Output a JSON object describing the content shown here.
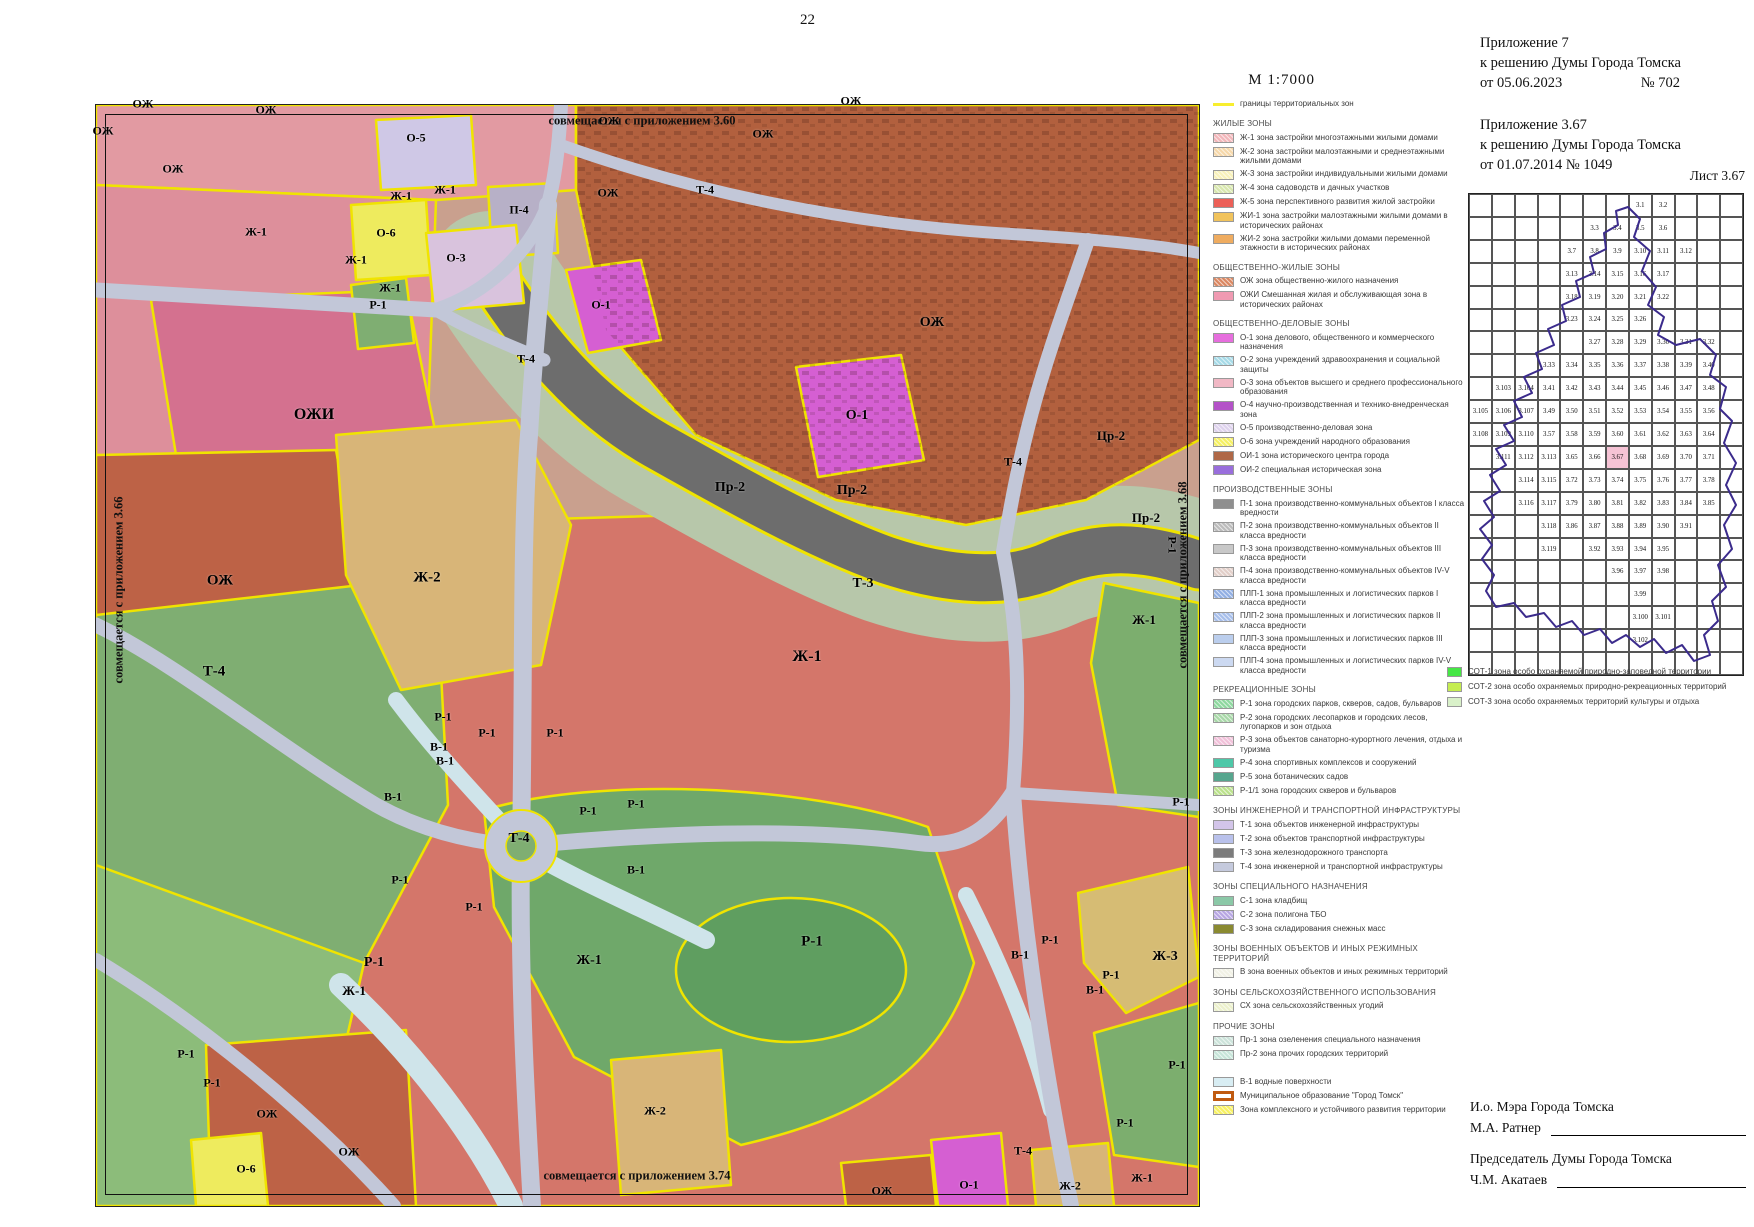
{
  "page": {
    "number": "22",
    "scale": "М 1:7000"
  },
  "header": {
    "a7_1": "Приложение 7",
    "a7_2": "к решению Думы Города Томска",
    "a7_3a": "от 05.06.2023",
    "a7_3b": "№ 702",
    "a367_1": "Приложение 3.67",
    "a367_2": "к решению Думы Города Томска",
    "a367_3": "от 01.07.2014  № 1049",
    "sheet": "Лист 3.67"
  },
  "map": {
    "edge_notes": {
      "top": "совмещается с приложением 3.60",
      "left": "совмещается с приложением 3.66",
      "right": "совмещается с приложением 3.68",
      "bottom": "совмещается с приложением 3.74"
    },
    "labels": [
      {
        "t": "ОЖ",
        "x": 143,
        "y": 104
      },
      {
        "t": "ОЖ",
        "x": 266,
        "y": 110
      },
      {
        "t": "ОЖ",
        "x": 103,
        "y": 131
      },
      {
        "t": "ОЖ",
        "x": 173,
        "y": 169
      },
      {
        "t": "О-5",
        "x": 416,
        "y": 138
      },
      {
        "t": "ОЖ",
        "x": 609,
        "y": 121
      },
      {
        "t": "ОЖ",
        "x": 763,
        "y": 134
      },
      {
        "t": "ОЖ",
        "x": 851,
        "y": 101
      },
      {
        "t": "Ж-1",
        "x": 401,
        "y": 196
      },
      {
        "t": "Ж-1",
        "x": 445,
        "y": 190
      },
      {
        "t": "П-4",
        "x": 519,
        "y": 210
      },
      {
        "t": "ОЖ",
        "x": 608,
        "y": 193
      },
      {
        "t": "Т-4",
        "x": 705,
        "y": 190
      },
      {
        "t": "Ж-1",
        "x": 256,
        "y": 232
      },
      {
        "t": "О-6",
        "x": 386,
        "y": 233
      },
      {
        "t": "О-3",
        "x": 456,
        "y": 258
      },
      {
        "t": "Ж-1",
        "x": 356,
        "y": 260
      },
      {
        "t": "Ж-1",
        "x": 390,
        "y": 288
      },
      {
        "t": "Р-1",
        "x": 378,
        "y": 305
      },
      {
        "t": "О-1",
        "x": 601,
        "y": 305
      },
      {
        "t": "Т-4",
        "x": 526,
        "y": 359
      },
      {
        "t": "ОЖ",
        "x": 932,
        "y": 323,
        "s": 14
      },
      {
        "t": "О-1",
        "x": 857,
        "y": 416,
        "s": 14
      },
      {
        "t": "Т-4",
        "x": 1013,
        "y": 462
      },
      {
        "t": "Цр-2",
        "x": 1111,
        "y": 436,
        "s": 13
      },
      {
        "t": "ОЖИ",
        "x": 314,
        "y": 415,
        "s": 16
      },
      {
        "t": "Пр-2",
        "x": 730,
        "y": 488,
        "s": 14
      },
      {
        "t": "Пр-2",
        "x": 852,
        "y": 491,
        "s": 14
      },
      {
        "t": "Пр-2",
        "x": 1146,
        "y": 518,
        "s": 13
      },
      {
        "t": "ОЖ",
        "x": 220,
        "y": 581,
        "s": 15
      },
      {
        "t": "Ж-2",
        "x": 427,
        "y": 578,
        "s": 15
      },
      {
        "t": "Т-3",
        "x": 863,
        "y": 584,
        "s": 14
      },
      {
        "t": "Ж-1",
        "x": 1144,
        "y": 620,
        "s": 13
      },
      {
        "t": "Р-1",
        "x": 1172,
        "y": 545,
        "r": 90
      },
      {
        "t": "Т-4",
        "x": 214,
        "y": 672,
        "s": 15
      },
      {
        "t": "Ж-1",
        "x": 807,
        "y": 657,
        "s": 16
      },
      {
        "t": "Р-1",
        "x": 443,
        "y": 717
      },
      {
        "t": "Р-1",
        "x": 487,
        "y": 733
      },
      {
        "t": "В-1",
        "x": 439,
        "y": 747
      },
      {
        "t": "Р-1",
        "x": 555,
        "y": 733
      },
      {
        "t": "В-1",
        "x": 445,
        "y": 761
      },
      {
        "t": "В-1",
        "x": 393,
        "y": 797
      },
      {
        "t": "Р-1",
        "x": 588,
        "y": 811
      },
      {
        "t": "Р-1",
        "x": 636,
        "y": 804
      },
      {
        "t": "Т-4",
        "x": 519,
        "y": 839,
        "s": 14
      },
      {
        "t": "В-1",
        "x": 636,
        "y": 870
      },
      {
        "t": "Р-1",
        "x": 400,
        "y": 880
      },
      {
        "t": "Р-1",
        "x": 474,
        "y": 907
      },
      {
        "t": "Р-1",
        "x": 1181,
        "y": 802
      },
      {
        "t": "Р-1",
        "x": 812,
        "y": 942,
        "s": 15
      },
      {
        "t": "Р-1",
        "x": 1050,
        "y": 940
      },
      {
        "t": "В-1",
        "x": 1020,
        "y": 955
      },
      {
        "t": "Ж-1",
        "x": 589,
        "y": 961,
        "s": 14
      },
      {
        "t": "Р-1",
        "x": 374,
        "y": 963,
        "s": 14
      },
      {
        "t": "Ж-3",
        "x": 1165,
        "y": 957,
        "s": 14
      },
      {
        "t": "Р-1",
        "x": 1111,
        "y": 975
      },
      {
        "t": "В-1",
        "x": 1095,
        "y": 990
      },
      {
        "t": "Ж-1",
        "x": 354,
        "y": 991,
        "s": 13
      },
      {
        "t": "Р-1",
        "x": 186,
        "y": 1054
      },
      {
        "t": "Р-1",
        "x": 212,
        "y": 1083
      },
      {
        "t": "ОЖ",
        "x": 267,
        "y": 1114
      },
      {
        "t": "Ж-2",
        "x": 655,
        "y": 1111
      },
      {
        "t": "Р-1",
        "x": 1177,
        "y": 1065
      },
      {
        "t": "О-6",
        "x": 246,
        "y": 1169
      },
      {
        "t": "ОЖ",
        "x": 349,
        "y": 1152
      },
      {
        "t": "Р-1",
        "x": 1125,
        "y": 1123
      },
      {
        "t": "Т-4",
        "x": 1023,
        "y": 1151
      },
      {
        "t": "О-1",
        "x": 969,
        "y": 1185
      },
      {
        "t": "Ж-2",
        "x": 1070,
        "y": 1186
      },
      {
        "t": "Ж-1",
        "x": 1142,
        "y": 1178
      },
      {
        "t": "ОЖ",
        "x": 882,
        "y": 1191
      }
    ]
  },
  "legend": {
    "boundary_item": {
      "label": "границы территориальных зон",
      "color": "#f8ee2e"
    },
    "sections": [
      {
        "title": "ЖИЛЫЕ ЗОНЫ",
        "items": [
          {
            "label": "Ж-1 зона застройки многоэтажными жилыми домами",
            "color": "#f2b6ba",
            "hatch": true
          },
          {
            "label": "Ж-2 зона застройки малоэтажными и среднеэтажными жилыми домами",
            "color": "#f6d8aa",
            "hatch": true
          },
          {
            "label": "Ж-3 зона застройки индивидуальными жилыми домами",
            "color": "#f8f1ba",
            "hatch": true
          },
          {
            "label": "Ж-4 зона садоводств и дачных участков",
            "color": "#d8e7ae",
            "hatch": true
          },
          {
            "label": "Ж-5 зона перспективного развития жилой застройки",
            "color": "#ec6058",
            "hatch": false
          },
          {
            "label": "ЖИ-1 зона застройки малоэтажными жилыми домами в исторических районах",
            "color": "#f1c35c",
            "hatch": false
          },
          {
            "label": "ЖИ-2 зона застройки жилыми домами переменной этажности в исторических районах",
            "color": "#efac60",
            "hatch": false
          }
        ]
      },
      {
        "title": "ОБЩЕСТВЕННО-ЖИЛЫЕ ЗОНЫ",
        "items": [
          {
            "label": "ОЖ зона общественно-жилого назначения",
            "color": "#db8862",
            "hatch": true
          },
          {
            "label": "ОЖИ Смешанная жилая и обслуживающая зона в исторических районах",
            "color": "#f09ab2",
            "hatch": false
          }
        ]
      },
      {
        "title": "ОБЩЕСТВЕННО-ДЕЛОВЫЕ ЗОНЫ",
        "items": [
          {
            "label": "О-1 зона делового, общественного и коммерческого назначения",
            "color": "#e66edd",
            "hatch": false
          },
          {
            "label": "О-2 зона учреждений здравоохранения и социальной защиты",
            "color": "#a6dae7",
            "hatch": true
          },
          {
            "label": "О-3 зона объектов высшего и среднего профессионального образования",
            "color": "#f1b8c5",
            "hatch": false
          },
          {
            "label": "О-4 научно-производственная и технико-внедренческая зона",
            "color": "#b452c8",
            "hatch": false
          },
          {
            "label": "О-5 производственно-деловая зона",
            "color": "#ded2ed",
            "hatch": true
          },
          {
            "label": "О-6 зона учреждений народного образования",
            "color": "#f5f062",
            "hatch": true
          },
          {
            "label": "ОИ-1 зона исторического центра города",
            "color": "#af6847",
            "hatch": false
          },
          {
            "label": "ОИ-2 специальная историческая зона",
            "color": "#996edc",
            "hatch": false
          }
        ]
      },
      {
        "title": "ПРОИЗВОДСТВЕННЫЕ ЗОНЫ",
        "items": [
          {
            "label": "П-1 зона производственно-коммунальных объектов I класса вредности",
            "color": "#8f8f8f",
            "hatch": false
          },
          {
            "label": "П-2 зона производственно-коммунальных объектов II класса вредности",
            "color": "#bcbcbc",
            "hatch": true
          },
          {
            "label": "П-3 зона производственно-коммунальных объектов III класса вредности",
            "color": "#c8c8c8",
            "hatch": false
          },
          {
            "label": "П-4 зона производственно-коммунальных объектов IV-V класса вредности",
            "color": "#e2cfc9",
            "hatch": true
          },
          {
            "label": "ПЛП-1 зона промышленных и логистических парков I класса вредности",
            "color": "#92afe3",
            "hatch": true
          },
          {
            "label": "ПЛП-2 зона промышленных и логистических парков II класса вредности",
            "color": "#a7bfeb",
            "hatch": true
          },
          {
            "label": "ПЛП-3 зона промышленных и логистических парков III класса вредности",
            "color": "#bbceed",
            "hatch": false
          },
          {
            "label": "ПЛП-4 зона промышленных и логистических парков IV-V класса вредности",
            "color": "#ccd9f1",
            "hatch": false
          }
        ]
      },
      {
        "title": "РЕКРЕАЦИОННЫЕ ЗОНЫ",
        "items": [
          {
            "label": "Р-1 зона городских парков, скверов, садов, бульваров",
            "color": "#8ed89f",
            "hatch": true
          },
          {
            "label": "Р-2 зона городских лесопарков и городских лесов, лугопарков и зон отдыха",
            "color": "#a8d8a8",
            "hatch": true
          },
          {
            "label": "Р-3 зона объектов санаторно-курортного лечения, отдыха и туризма",
            "color": "#f1c1d9",
            "hatch": true
          },
          {
            "label": "Р-4 зона спортивных комплексов и сооружений",
            "color": "#4ec8a8",
            "hatch": false
          },
          {
            "label": "Р-5 зона ботанических садов",
            "color": "#57a68e",
            "hatch": false
          },
          {
            "label": "Р-1/1 зона городских скверов и бульваров",
            "color": "#bbe18c",
            "hatch": true
          }
        ]
      },
      {
        "title": "ЗОНЫ ИНЖЕНЕРНОЙ И ТРАНСПОРТНОЙ ИНФРАСТРУКТУРЫ",
        "items": [
          {
            "label": "Т-1 зона объектов инженерной инфраструктуры",
            "color": "#d3c5e9",
            "hatch": false
          },
          {
            "label": "Т-2 зона объектов транспортной инфраструктуры",
            "color": "#b9c1eb",
            "hatch": false
          },
          {
            "label": "Т-3 зона железнодорожного транспорта",
            "color": "#7c7c7c",
            "hatch": false
          },
          {
            "label": "Т-4 зона инженерной и транспортной инфраструктуры",
            "color": "#c5cadd",
            "hatch": false
          }
        ]
      },
      {
        "title": "ЗОНЫ СПЕЦИАЛЬНОГО НАЗНАЧЕНИЯ",
        "items": [
          {
            "label": "С-1 зона кладбищ",
            "color": "#8bc8a7",
            "hatch": false
          },
          {
            "label": "С-2 зона полигона ТБО",
            "color": "#b8a7e3",
            "hatch": true
          },
          {
            "label": "С-3 зона складирования снежных масс",
            "color": "#8a8a31",
            "hatch": false
          }
        ]
      },
      {
        "title": "ЗОНЫ ВОЕННЫХ ОБЪЕКТОВ И ИНЫХ РЕЖИМНЫХ ТЕРРИТОРИЙ",
        "items": [
          {
            "label": "В зона военных объектов и иных режимных территорий",
            "color": "#f1f1e5",
            "hatch": true
          }
        ]
      },
      {
        "title": "ЗОНЫ СЕЛЬСКОХОЗЯЙСТВЕННОГО ИСПОЛЬЗОВАНИЯ",
        "items": [
          {
            "label": "СХ зона сельскохозяйственных угодий",
            "color": "#ecf1cc",
            "hatch": true
          }
        ]
      },
      {
        "title": "ПРОЧИЕ ЗОНЫ",
        "items": [
          {
            "label": "Пр-1 зона озеленения специального назначения",
            "color": "#cce3da",
            "hatch": true
          },
          {
            "label": "Пр-2 зона прочих городских территорий",
            "color": "#c7e5d9",
            "hatch": true
          }
        ]
      }
    ],
    "extra_items": [
      {
        "label": "В-1 водные поверхности",
        "color": "#d8edf3",
        "type": "fill"
      },
      {
        "label": "Муниципальное образование \"Город Томск\"",
        "color": "#c05a10",
        "type": "outline"
      },
      {
        "label": "Зона комплексного и устойчивого развития территории",
        "color": "#f7f162",
        "type": "fill",
        "hatch": true
      }
    ],
    "sot_items": [
      {
        "label": "СОТ-1 зона особо охраняемой природно-заповедной территории",
        "color": "#45e745"
      },
      {
        "label": "СОТ-2 зона особо охраняемых природно-рекреационных территорий",
        "color": "#c5ed51"
      },
      {
        "label": "СОТ-3 зона особо охраняемых территорий культуры и отдыха",
        "color": "#d9f1c9"
      }
    ]
  },
  "index_map": {
    "highlight": "3.67",
    "highlight_color": "#f6c3d5",
    "rows": [
      [
        "",
        "",
        "",
        "",
        "",
        "",
        "",
        "3.1",
        "3.2",
        "",
        "",
        ""
      ],
      [
        "",
        "",
        "",
        "",
        "",
        "3.3",
        "3.4",
        "3.5",
        "3.6",
        "",
        "",
        ""
      ],
      [
        "",
        "",
        "",
        "",
        "3.7",
        "3.8",
        "3.9",
        "3.10",
        "3.11",
        "3.12",
        "",
        ""
      ],
      [
        "",
        "",
        "",
        "",
        "3.13",
        "3.14",
        "3.15",
        "3.16",
        "3.17",
        "",
        "",
        ""
      ],
      [
        "",
        "",
        "",
        "",
        "3.18",
        "3.19",
        "3.20",
        "3.21",
        "3.22",
        "",
        "",
        ""
      ],
      [
        "",
        "",
        "",
        "",
        "3.23",
        "3.24",
        "3.25",
        "3.26",
        "",
        "",
        "",
        ""
      ],
      [
        "",
        "",
        "",
        "",
        "",
        "3.27",
        "3.28",
        "3.29",
        "3.30",
        "3.31",
        "3.32",
        ""
      ],
      [
        "",
        "",
        "",
        "3.33",
        "3.34",
        "3.35",
        "3.36",
        "3.37",
        "3.38",
        "3.39",
        "3.40",
        ""
      ],
      [
        "",
        "3.103",
        "3.104",
        "3.41",
        "3.42",
        "3.43",
        "3.44",
        "3.45",
        "3.46",
        "3.47",
        "3.48",
        ""
      ],
      [
        "3.105",
        "3.106",
        "3.107",
        "3.49",
        "3.50",
        "3.51",
        "3.52",
        "3.53",
        "3.54",
        "3.55",
        "3.56",
        ""
      ],
      [
        "3.108",
        "3.109",
        "3.110",
        "3.57",
        "3.58",
        "3.59",
        "3.60",
        "3.61",
        "3.62",
        "3.63",
        "3.64",
        ""
      ],
      [
        "",
        "3.111",
        "3.112",
        "3.113",
        "3.65",
        "3.66",
        "3.67",
        "3.68",
        "3.69",
        "3.70",
        "3.71",
        ""
      ],
      [
        "",
        "",
        "3.114",
        "3.115",
        "3.72",
        "3.73",
        "3.74",
        "3.75",
        "3.76",
        "3.77",
        "3.78",
        ""
      ],
      [
        "",
        "",
        "3.116",
        "3.117",
        "3.79",
        "3.80",
        "3.81",
        "3.82",
        "3.83",
        "3.84",
        "3.85",
        ""
      ],
      [
        "",
        "",
        "",
        "3.118",
        "3.86",
        "3.87",
        "3.88",
        "3.89",
        "3.90",
        "3.91",
        "",
        ""
      ],
      [
        "",
        "",
        "",
        "3.119",
        "",
        "3.92",
        "3.93",
        "3.94",
        "3.95",
        "",
        "",
        ""
      ],
      [
        "",
        "",
        "",
        "",
        "",
        "",
        "3.96",
        "3.97",
        "3.98",
        "",
        "",
        ""
      ],
      [
        "",
        "",
        "",
        "",
        "",
        "",
        "",
        "3.99",
        "",
        "",
        "",
        ""
      ],
      [
        "",
        "",
        "",
        "",
        "",
        "",
        "",
        "3.100",
        "3.101",
        "",
        "",
        ""
      ],
      [
        "",
        "",
        "",
        "",
        "",
        "",
        "",
        "3.102",
        "",
        "",
        "",
        ""
      ],
      [
        "",
        "",
        "",
        "",
        "",
        "",
        "",
        "",
        "",
        "",
        "",
        ""
      ]
    ]
  },
  "signatures": {
    "sig1_title": "И.о. Мэра Города Томска",
    "sig1_name": "М.А. Ратнер",
    "sig2_title": "Председатель Думы Города Томска",
    "sig2_name": "Ч.М. Акатаев"
  }
}
